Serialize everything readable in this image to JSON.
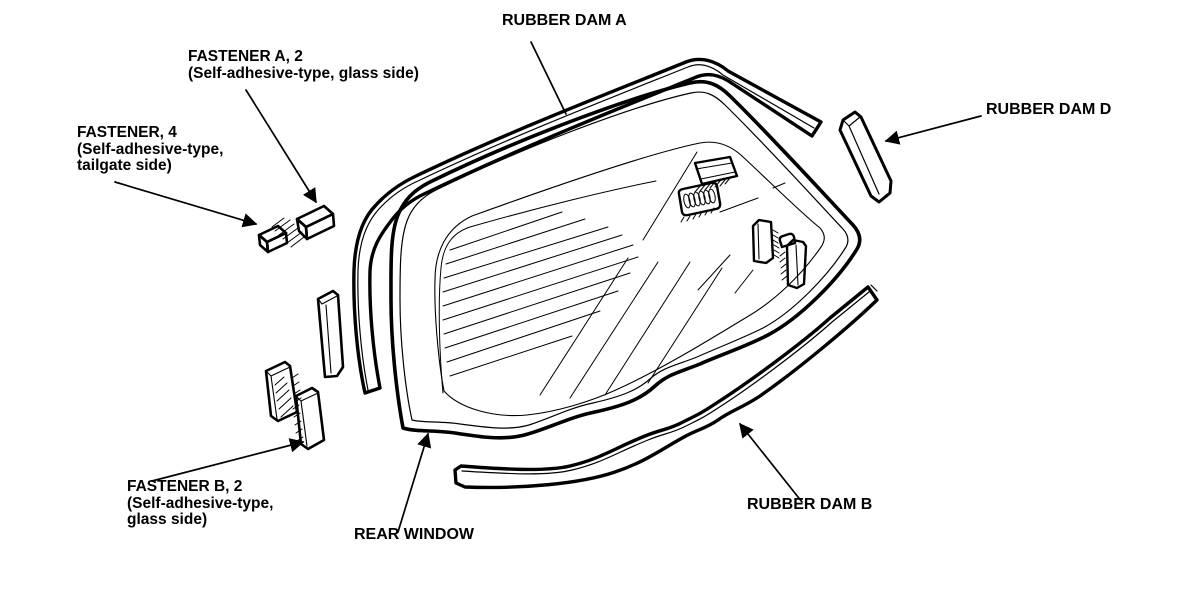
{
  "diagram": {
    "type": "exploded-parts-line-drawing",
    "subject": "rear window glass with rubber dams and fasteners",
    "colors": {
      "line": "#000000",
      "background": "#ffffff"
    },
    "labels": {
      "rubber_dam_a": "RUBBER DAM A",
      "rubber_dam_b": "RUBBER DAM B",
      "rubber_dam_d": "RUBBER DAM D",
      "rear_window": "REAR WINDOW",
      "fastener_a_line1": "FASTENER A, 2",
      "fastener_a_line2": "(Self-adhesive-type, glass side)",
      "fastener_tailgate_line1": "FASTENER, 4",
      "fastener_tailgate_line2": "(Self-adhesive-type,",
      "fastener_tailgate_line3": "tailgate side)",
      "fastener_b_line1": "FASTENER B, 2",
      "fastener_b_line2": "(Self-adhesive-type,",
      "fastener_b_line3": "glass side)"
    }
  }
}
